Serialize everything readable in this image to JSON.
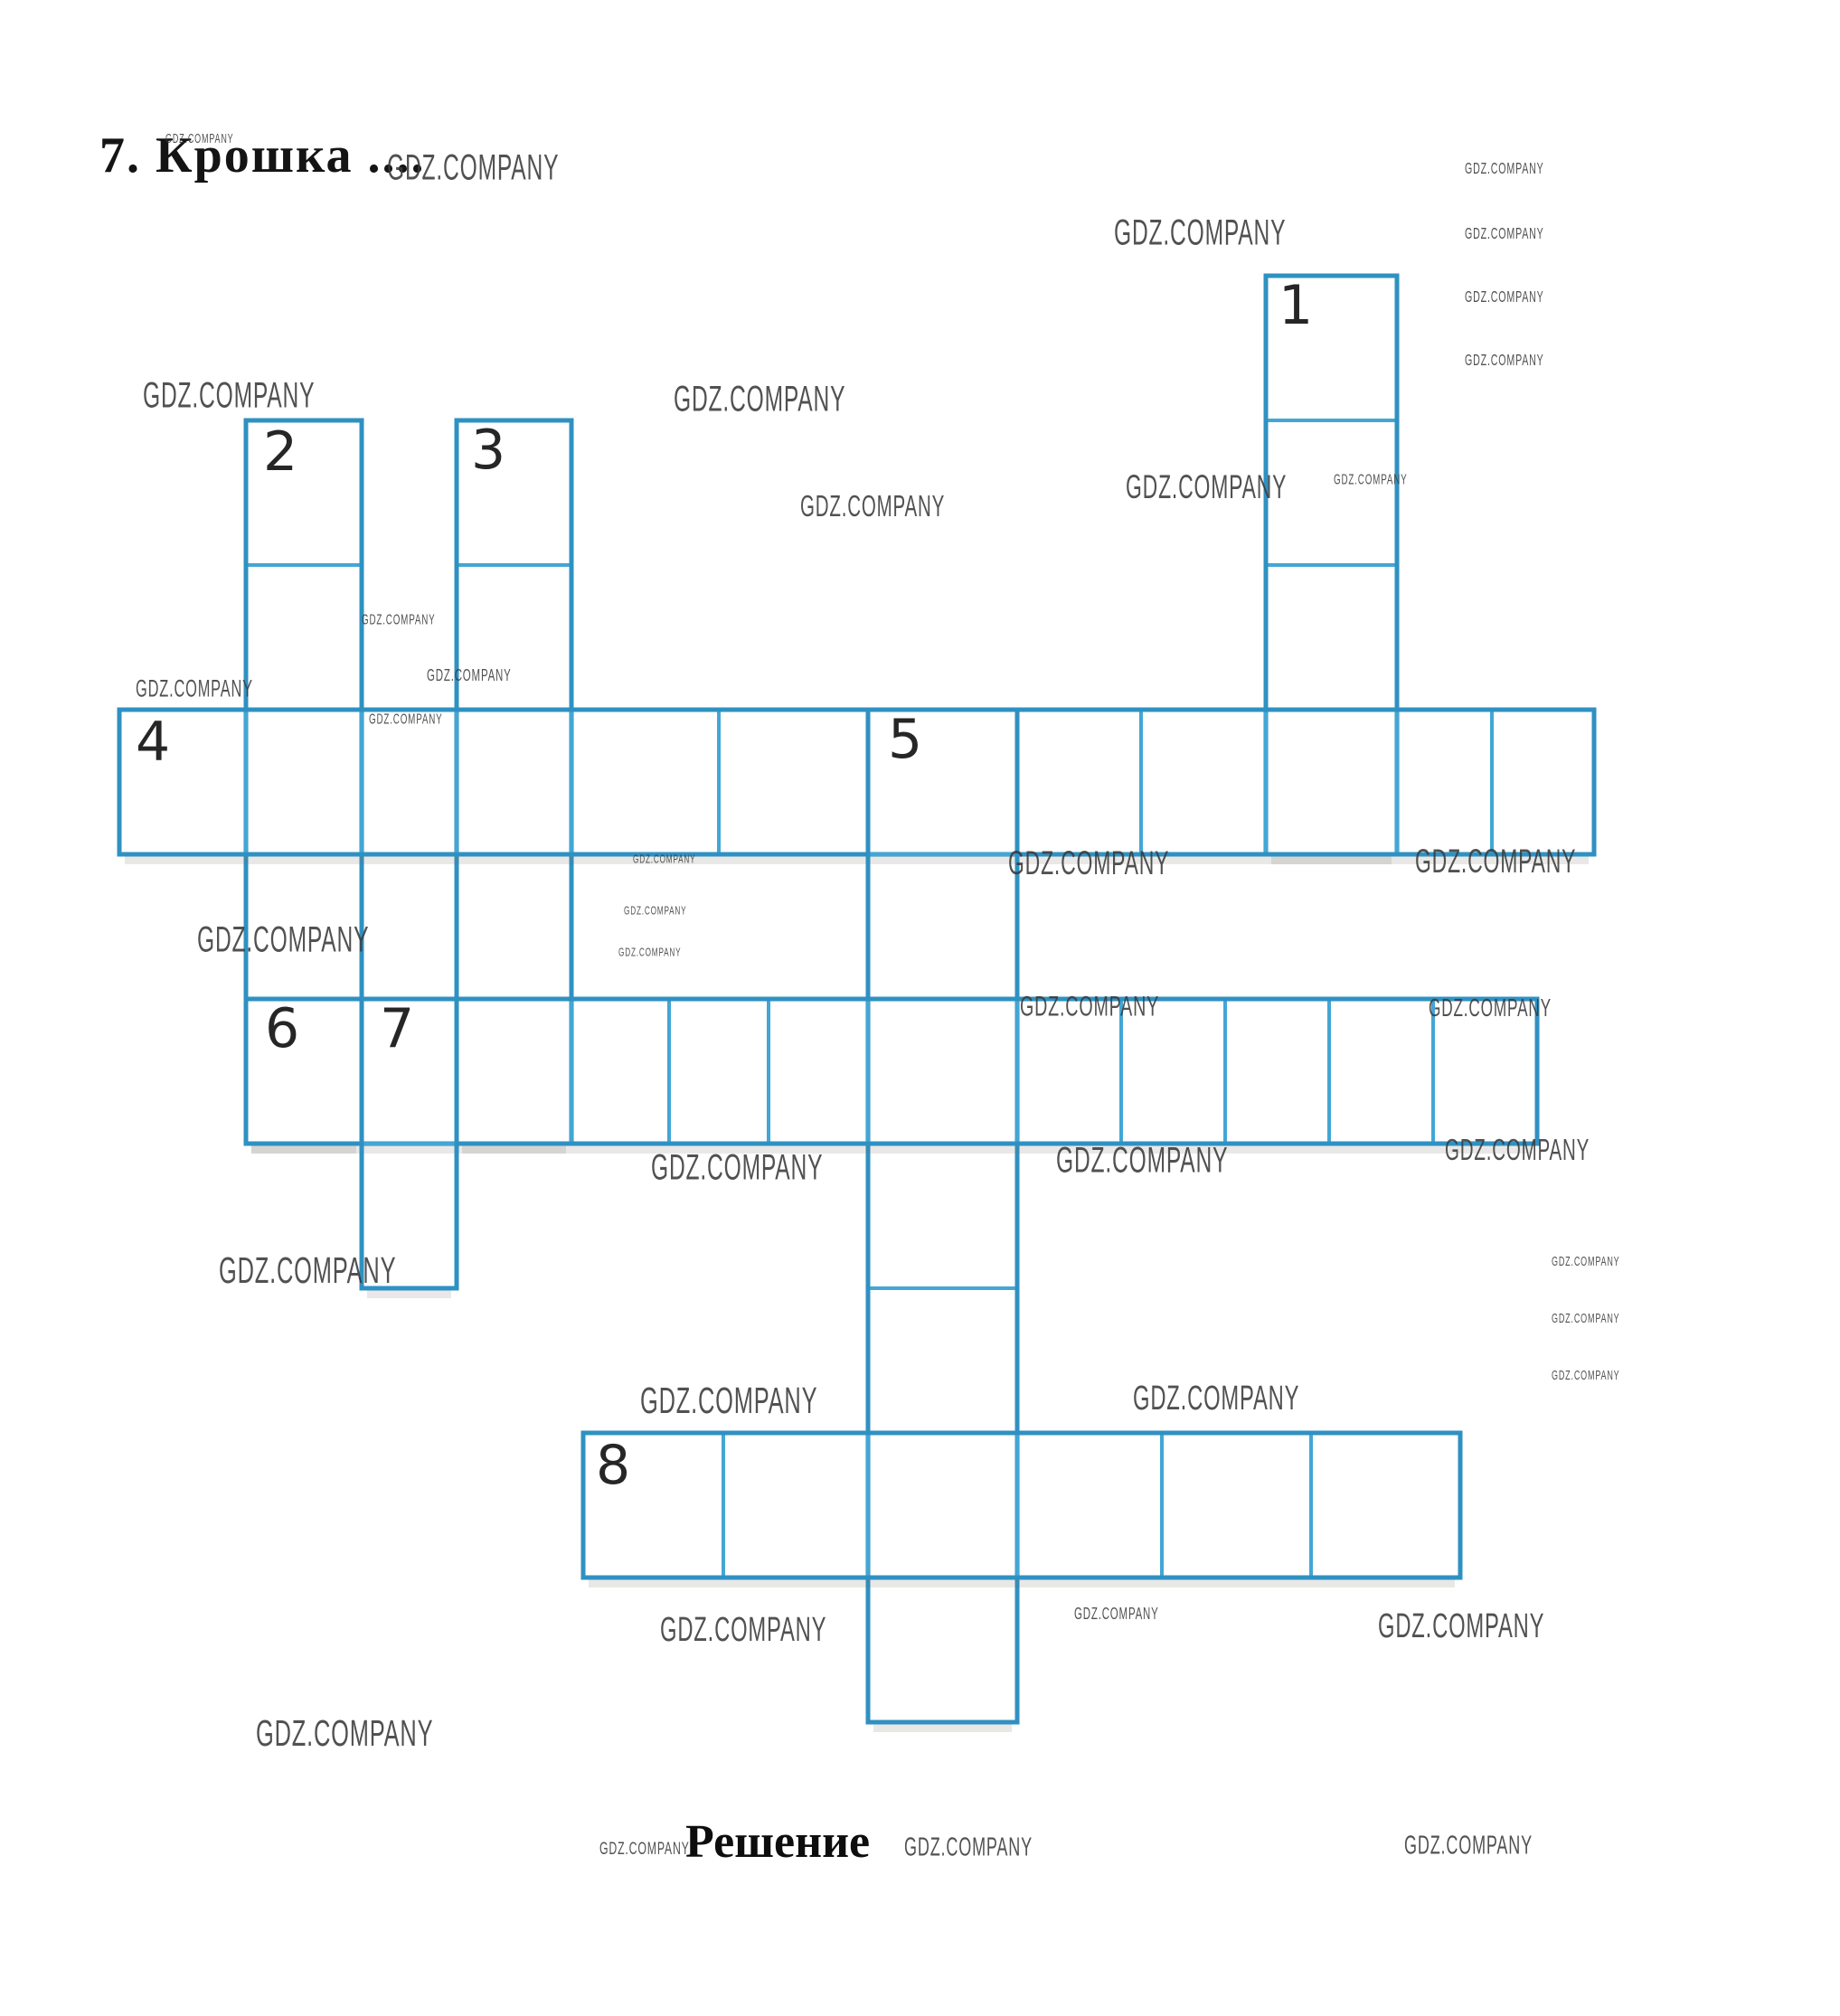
{
  "page": {
    "title": "7. Крошка ....",
    "solution_label": "Решение"
  },
  "watermark": {
    "text": "GDZ.COMPANY",
    "color": "#3a3a3a",
    "placements": [
      [
        183,
        146,
        11
      ],
      [
        428,
        164,
        30
      ],
      [
        1232,
        236,
        30
      ],
      [
        1620,
        176,
        13
      ],
      [
        1620,
        248,
        13
      ],
      [
        1620,
        318,
        13
      ],
      [
        1620,
        388,
        13
      ],
      [
        158,
        416,
        30
      ],
      [
        745,
        420,
        30
      ],
      [
        1245,
        518,
        28
      ],
      [
        1475,
        521,
        12
      ],
      [
        885,
        542,
        25
      ],
      [
        150,
        748,
        20
      ],
      [
        400,
        676,
        12
      ],
      [
        472,
        736,
        14
      ],
      [
        408,
        786,
        12
      ],
      [
        700,
        944,
        10
      ],
      [
        690,
        1001,
        10
      ],
      [
        684,
        1047,
        10
      ],
      [
        1115,
        934,
        28
      ],
      [
        1565,
        932,
        28
      ],
      [
        218,
        1018,
        30
      ],
      [
        1128,
        1096,
        24
      ],
      [
        1580,
        1100,
        21
      ],
      [
        720,
        1270,
        30
      ],
      [
        1168,
        1262,
        30
      ],
      [
        1598,
        1254,
        25
      ],
      [
        242,
        1382,
        31
      ],
      [
        1716,
        1388,
        11
      ],
      [
        1716,
        1451,
        11
      ],
      [
        1716,
        1514,
        11
      ],
      [
        708,
        1526,
        31
      ],
      [
        1253,
        1526,
        29
      ],
      [
        730,
        1782,
        29
      ],
      [
        1188,
        1774,
        14
      ],
      [
        1524,
        1778,
        29
      ],
      [
        283,
        1894,
        31
      ],
      [
        663,
        2034,
        15
      ],
      [
        1000,
        2026,
        22
      ],
      [
        1553,
        2024,
        22
      ]
    ]
  },
  "grid": {
    "line_color": "#43a6d5",
    "outline_color": "#2f91c2",
    "words": [
      {
        "number": "1",
        "direction": "down",
        "span": [
          1400,
          1545
        ],
        "borders": [
          305,
          465,
          625,
          785,
          945
        ],
        "number_pos": [
          1414,
          308
        ]
      },
      {
        "number": "2",
        "direction": "down",
        "span": [
          272,
          400
        ],
        "borders": [
          465,
          625,
          785,
          945,
          1105,
          1265
        ],
        "number_pos": [
          291,
          470
        ]
      },
      {
        "number": "3",
        "direction": "down",
        "span": [
          505,
          632
        ],
        "borders": [
          465,
          625,
          785,
          945,
          1105,
          1265
        ],
        "number_pos": [
          521,
          468
        ]
      },
      {
        "number": "4",
        "direction": "across",
        "span": [
          785,
          945
        ],
        "borders": [
          132,
          272,
          400,
          505,
          632,
          795,
          960,
          1125,
          1262,
          1400,
          1545,
          1650,
          1763
        ],
        "number_pos": [
          150,
          791
        ]
      },
      {
        "number": "5",
        "direction": "down",
        "span": [
          960,
          1125
        ],
        "borders": [
          785,
          945,
          1105,
          1265,
          1425,
          1585,
          1745,
          1905
        ],
        "number_pos": [
          982,
          788
        ]
      },
      {
        "number": "6",
        "direction": "across",
        "span": [
          1105,
          1265
        ],
        "borders": [
          272,
          400,
          505,
          632,
          740,
          850,
          960,
          1125,
          1240,
          1355,
          1470,
          1585,
          1700
        ],
        "number_pos": [
          293,
          1108
        ]
      },
      {
        "number": "7",
        "direction": "down",
        "span": [
          400,
          505
        ],
        "borders": [
          1105,
          1265,
          1425
        ],
        "number_pos": [
          420,
          1108
        ]
      },
      {
        "number": "8",
        "direction": "across",
        "span": [
          1585,
          1745
        ],
        "borders": [
          645,
          800,
          960,
          1125,
          1285,
          1450,
          1615
        ],
        "number_pos": [
          659,
          1591
        ]
      }
    ]
  }
}
